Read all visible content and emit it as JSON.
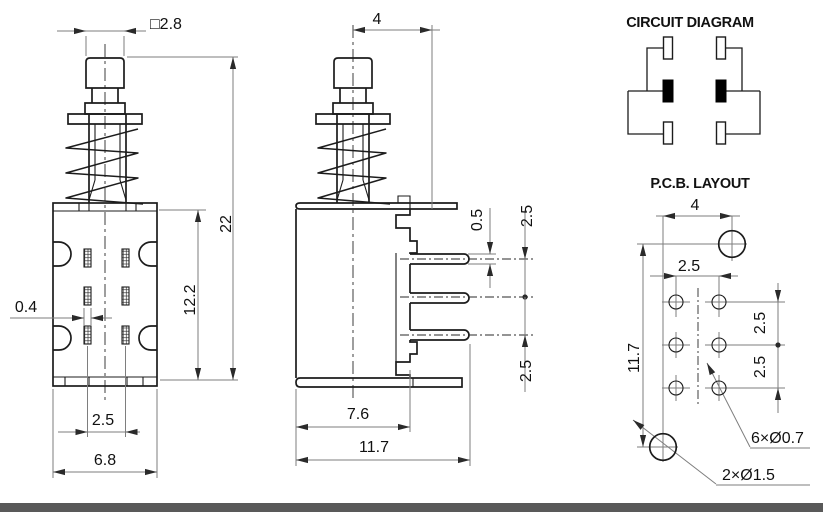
{
  "drawing": {
    "colors": {
      "line": "#1c1c1c",
      "dimension": "#7e7e7e",
      "text": "#111111",
      "footer_bar": "#595959"
    },
    "front_view": {
      "dim_cap_width": "□2.8",
      "dim_total_height": "22",
      "dim_body_height": "12.2",
      "dim_terminal_width": "0.4",
      "dim_terminal_pitch": "2.5",
      "dim_body_width": "6.8"
    },
    "side_view": {
      "dim_center_to_edge": "4",
      "dim_pin_thickness": "0.5",
      "dim_pin_pitch_upper": "2.5",
      "dim_pin_pitch_lower": "2.5",
      "dim_body_depth": "7.6",
      "dim_overall_depth": "11.7"
    },
    "circuit_diagram": {
      "title": "CIRCUIT DIAGRAM"
    },
    "pcb_layout": {
      "title": "P.C.B. LAYOUT",
      "dim_hole_offset_x": "4",
      "dim_hole_pitch_x": "2.5",
      "dim_overall_height": "11.7",
      "dim_hole_pitch_y_upper": "2.5",
      "dim_hole_pitch_y_lower": "2.5",
      "label_small_holes": "6×Ø0.7",
      "label_large_holes": "2×Ø1.5"
    }
  }
}
